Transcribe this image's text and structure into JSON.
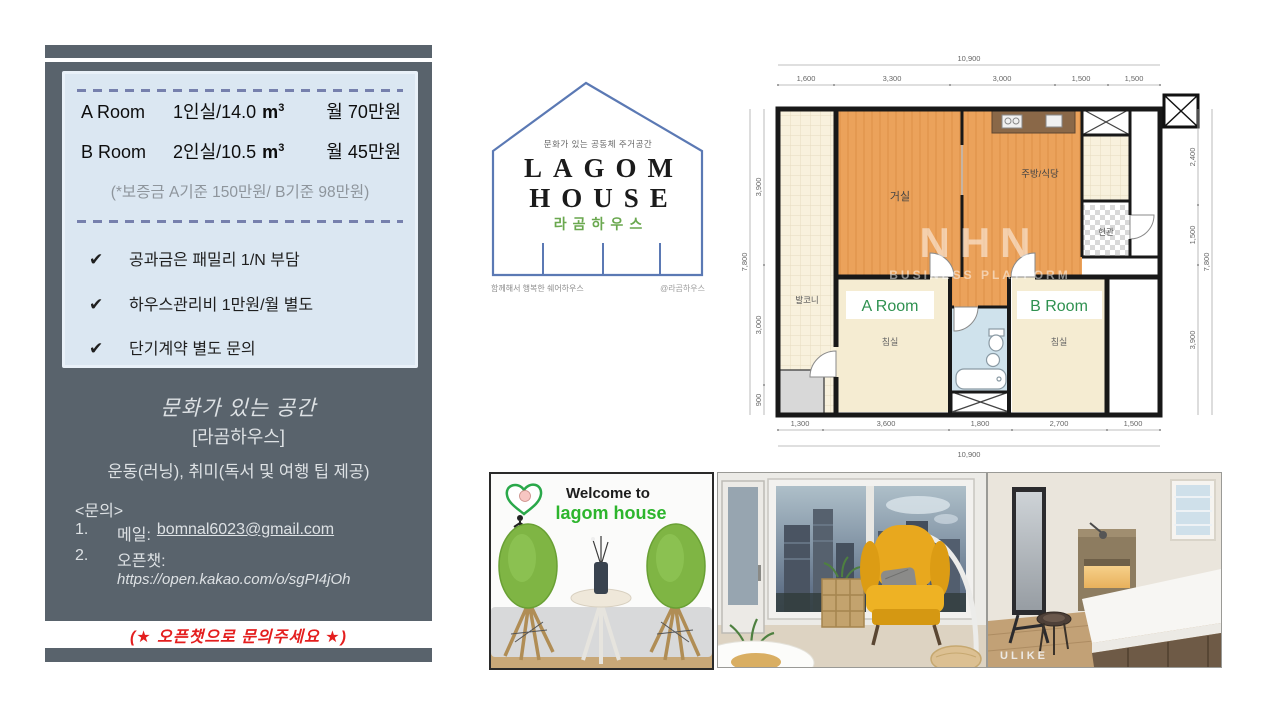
{
  "flyer": {
    "rooms": [
      {
        "name": "A Room",
        "desc": "1인실/14.0",
        "unit": "m",
        "unit_sup": "3",
        "price": "월 70만원"
      },
      {
        "name": "B Room",
        "desc": "2인실/10.5",
        "unit": "m",
        "unit_sup": "3",
        "price": "월 45만원"
      }
    ],
    "deposit_note": "(*보증금 A기준 150만원/ B기준 98만원)",
    "check_icon": "✔",
    "checklist": [
      "공과금은 패밀리 1/N 부담",
      "하우스관리비 1만원/월 별도",
      "단기계약 별도 문의"
    ],
    "tagline": "문화가 있는 공간",
    "house_name": "[라곰하우스]",
    "activities": "운동(러닝), 취미(독서 및 여행 팁 제공)",
    "contact_heading": "<문의>",
    "contact1_num": "1.",
    "contact1_label": "메일:",
    "contact1_value": "bomnal6023@gmail.com",
    "contact2_num": "2.",
    "contact2_label": "오픈챗:",
    "contact2_value": "https://open.kakao.com/o/sgPI4jOh",
    "footer_note": "(★ 오픈챗으로 문의주세요 ★)"
  },
  "logo": {
    "subtitle": "문화가 있는 공동체 주거공간",
    "name_line1": "LAGOM",
    "name_line2": "HOUSE",
    "korean_name": "라곰하우스",
    "bottom_left": "함께해서 행복한 쉐어하우스",
    "bottom_right": "@라곰하우스"
  },
  "floorplan": {
    "labels": {
      "balcony": "발코니",
      "living": "거실",
      "kitchen": "주방/식당",
      "entrance": "현관",
      "bedroom_a": "침실",
      "bedroom_b": "침실",
      "room_a": "A Room",
      "room_b": "B Room"
    },
    "dims": {
      "top_total": "10,900",
      "top_segments": [
        "1,600",
        "3,300",
        "3,000",
        "1,500",
        "1,500"
      ],
      "bottom_total": "10,900",
      "bottom_segments": [
        "1,300",
        "3,600",
        "1,800",
        "2,700",
        "1,500"
      ],
      "left_total": "7,800",
      "left_segments": [
        "3,900",
        "3,000",
        "900"
      ],
      "right_total": "7,800",
      "right_segments": [
        "2,400",
        "1,500",
        "3,900"
      ]
    },
    "watermark_line1": "NHN",
    "watermark_line2": "BUSINESS PLATFORM"
  },
  "photos": {
    "welcome_line1": "Welcome to",
    "welcome_line2": "lagom house",
    "photo3_watermark": "ULIKE"
  },
  "colors": {
    "panel": "#59636c",
    "info_box": "#dbe7f2",
    "accent_red": "#e41e1e",
    "label_green": "#2f9150",
    "logo_blue": "#5b79b4",
    "logo_green": "#6aa84f",
    "plan_orange": "#eba25b",
    "plan_cream": "#f5ecd2",
    "plan_bath": "#cfe2ec"
  }
}
